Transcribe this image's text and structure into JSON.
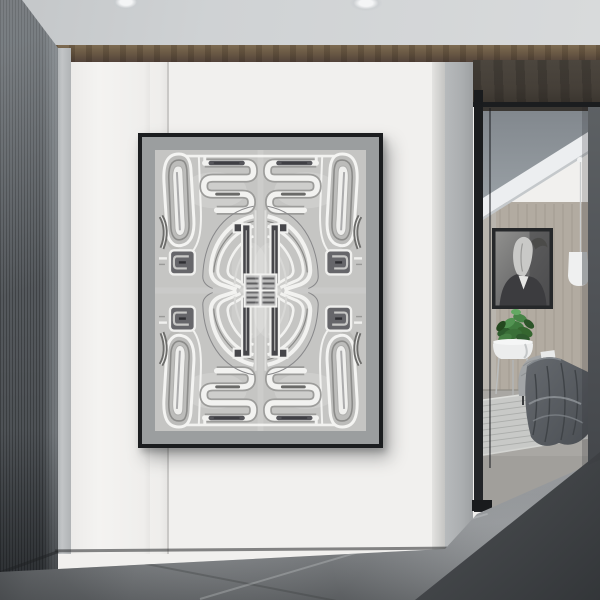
{
  "scene": {
    "title": "minimalist-hallway-with-abstract-art",
    "description": "Photograph of a modern interior: a large black-framed abstract symmetric gray artwork hangs on a white panel wall; a dark fluted wall on the left; an open black-framed doorway on the right reveals a bedroom with a horse portrait, white pendant lamp, potted plant on a stand, and a chair draped with a dark gray blanket over a light rug.",
    "objects": [
      {
        "name": "ceiling",
        "note": "light gray with two faint recessed lights"
      },
      {
        "name": "wood-trim",
        "note": "walnut strip between ceiling and wall"
      },
      {
        "name": "fluted-dark-wall",
        "note": "left foreground, vertical ribbed"
      },
      {
        "name": "white-panel-wall",
        "note": "four panels with thin vertical seams"
      },
      {
        "name": "framed-abstract-artwork",
        "note": "black frame, gray mat, symmetric tribal linework print"
      },
      {
        "name": "concrete-floor",
        "note": "gray with diagonal seams and corner shadows"
      },
      {
        "name": "doorway",
        "note": "black slim-frame glass opening"
      },
      {
        "name": "horse-portrait",
        "note": "black & white horse in a suit"
      },
      {
        "name": "pendant-lamp",
        "note": "white cylinder on thin cord"
      },
      {
        "name": "potted-plant",
        "note": "green plant in white bowl stand"
      },
      {
        "name": "lounge-chair-with-blanket",
        "note": "gray chair, dark draped throw"
      },
      {
        "name": "area-rug",
        "note": "light textured rug"
      }
    ]
  },
  "artwork": {
    "style": "abstract symmetric linework, 4-fold mirror",
    "frame_color": "#1b1d1f",
    "mat_color": "#9b9e9f",
    "print_background": "#c5c5c3",
    "line_color": "#f2f2f0",
    "accent_dark": "#46464a"
  },
  "palette": {
    "ceiling": "#ced1d3",
    "trim": "#6b5a45",
    "soffit": "#453f38",
    "wallWhite": "#f1f0ee",
    "seam": "#c9c8c6",
    "leftWall": "#53575b",
    "column": "#c2c5c7",
    "floor": "#8a8d90",
    "frameBlack": "#1b1d1f",
    "mat": "#9b9e9f",
    "jamb": "#515458",
    "roomWall": "#b2aba1",
    "roomCeiling": "#8b9298",
    "beam": "#eceef0",
    "rug": "#c8c9c7",
    "roomFloor": "#a9a7a3",
    "blanket": "#5a5e63",
    "chair": "#a2a5a7",
    "plantGreen": "#3f7a3e",
    "pot": "#eceded",
    "pendant": "#eff0f0",
    "portraitFrame": "#26282a"
  }
}
